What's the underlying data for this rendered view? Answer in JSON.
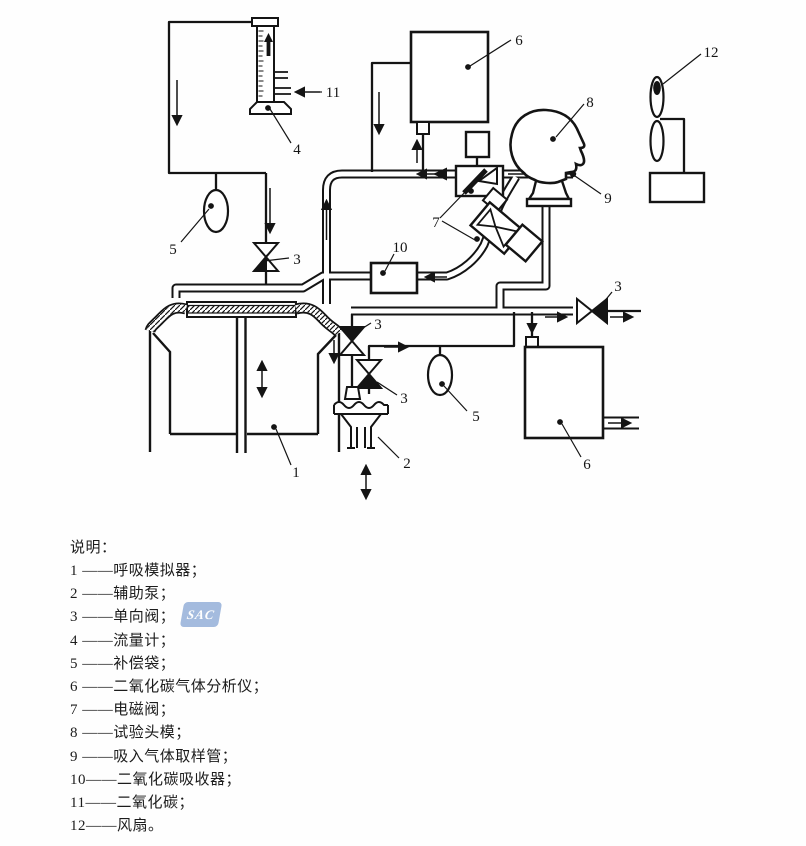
{
  "watermark": "SAC",
  "diagram": {
    "labels": [
      {
        "id": "analyzer-top",
        "text": "6"
      },
      {
        "id": "test-head",
        "text": "8"
      },
      {
        "id": "fan",
        "text": "12"
      },
      {
        "id": "co2-inlet",
        "text": "11"
      },
      {
        "id": "flowmeter",
        "text": "4"
      },
      {
        "id": "bag-left",
        "text": "5"
      },
      {
        "id": "check-valve-a",
        "text": "3"
      },
      {
        "id": "co2-absorber",
        "text": "10"
      },
      {
        "id": "solenoid-valves",
        "text": "7"
      },
      {
        "id": "sampling-tube",
        "text": "9"
      },
      {
        "id": "check-valve-d",
        "text": "3"
      },
      {
        "id": "check-valve-b",
        "text": "3"
      },
      {
        "id": "check-valve-c",
        "text": "3"
      },
      {
        "id": "bag-right",
        "text": "5"
      },
      {
        "id": "breath-simulator",
        "text": "1"
      },
      {
        "id": "aux-pump",
        "text": "2"
      },
      {
        "id": "analyzer-bottom",
        "text": "6"
      }
    ]
  },
  "legend": {
    "title": "说明：",
    "items": [
      "1 ——呼吸模拟器；",
      "2 ——辅助泵；",
      "3 ——单向阀；",
      "4 ——流量计；",
      "5 ——补偿袋；",
      "6 ——二氧化碳气体分析仪；",
      "7 ——电磁阀；",
      "8 ——试验头模；",
      "9 ——吸入气体取样管；",
      "10——二氧化碳吸收器；",
      "11——二氧化碳；",
      "12——风扇。"
    ]
  }
}
